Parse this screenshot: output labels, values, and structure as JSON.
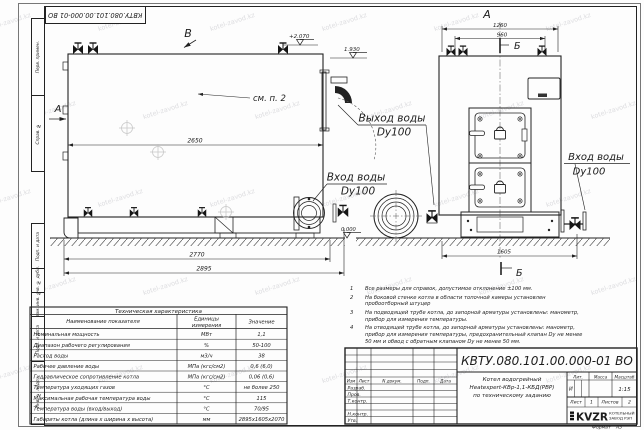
{
  "sheet": {
    "stamp_top": "КВТУ.080.101.00.000-01  ВО",
    "format_label": "Формат",
    "format_value": "А3",
    "margin_labels": [
      "Перв. примен.",
      "Справ. №",
      "Подп. и дата",
      "Инв. № дубл.",
      "Взам. инв. №",
      "Подп. и дата",
      "Инв. № подл."
    ],
    "watermark": "kotel-zavod.kz"
  },
  "drawing": {
    "views": {
      "top_arrow": "В",
      "front_title": "А",
      "side_arrow": "А",
      "section_mark": "Б"
    },
    "dims": {
      "side_length": "2650",
      "side_base": "2770",
      "side_overall": "2895",
      "front_width": "1260",
      "front_inner": "960",
      "front_overall": "1605"
    },
    "levels": {
      "top": "+2.070",
      "outlet": "1.930",
      "ground": "0.000"
    },
    "callouts": {
      "see_note": "см. п. 2",
      "out_line1": "Выход воды",
      "out_line2": "Dy100",
      "in_line1": "Вход воды",
      "in_line2": "Dy100"
    }
  },
  "spec_table": {
    "title": "Техническая характеристика",
    "col_name": "Наименование показателя",
    "col_unit_1": "Единицы",
    "col_unit_2": "измерения",
    "col_value": "Значение",
    "rows": [
      {
        "name": "Номинальная мощность",
        "unit": "МВт",
        "value": "1,1"
      },
      {
        "name": "Диапазон рабочего регулирования",
        "unit": "%",
        "value": "50-100"
      },
      {
        "name": "Расход воды",
        "unit": "м3/ч",
        "value": "38"
      },
      {
        "name": "Рабочее давление воды",
        "unit": "МПа (кгс/см2)",
        "value": "0,6 (6,0)"
      },
      {
        "name": "Гидравлическое сопротивление котла",
        "unit": "МПа (кгс/см2)",
        "value": "0,06 (0,6)"
      },
      {
        "name": "Температура уходящих газов",
        "unit": "°С",
        "value": "не более 250"
      },
      {
        "name": "Максимальная рабочая температура воды",
        "unit": "°С",
        "value": "115"
      },
      {
        "name": "Температура воды (вход/выход)",
        "unit": "°С",
        "value": "70/95"
      },
      {
        "name": "Габариты котла (длина х ширина х высота)",
        "unit": "мм",
        "value": "2895х1605х2070"
      }
    ]
  },
  "notes": {
    "items": [
      {
        "num": "1",
        "text": "Все размеры для справок, допустимое отклонение ±100 мм."
      },
      {
        "num": "2",
        "text": "На боковой стенке котла в области топочной камеры установлен пробоотборный штуцер"
      },
      {
        "num": "3",
        "text": "На подводящей трубе котла, до запорной арматуры установлены: манометр, прибор для измерения температуры."
      },
      {
        "num": "4",
        "text": "На отводящей трубе котла, до запорной арматуры установлены: манометр, прибор для измерения температуры, предохранительный клапан Dу не менее 50 мм и обвод с обратным клапаном Dу не менее 50 мм."
      }
    ]
  },
  "title_block": {
    "doc_number": "КВТУ.080.101.00.000-01 ВО",
    "product_lines": [
      "Котел водогрейный",
      "Heatexpert-КВр-1,1-КБД(РВР)",
      "по техническому заданию"
    ],
    "cols": {
      "izm": "Изм",
      "list": "Лист",
      "ndoc": "N докум.",
      "podp": "Подп.",
      "data": "Дата"
    },
    "rows": {
      "razrab": "Разраб.",
      "prov": "Пров.",
      "tkontr": "Т.контр.",
      "nkontr": "Н.контр.",
      "utv": "Утв."
    },
    "lit_label": "Лит.",
    "mass_label": "Масса",
    "scale_label": "Масштаб",
    "lit_value": "И",
    "scale_value": "1:15",
    "sheet_label": "Лист",
    "sheet_value": "1",
    "sheets_label": "Листов",
    "sheets_value": "2",
    "logo": "KVZR",
    "company_lines": [
      "КОТЕЛЬНЫЙ",
      "ЗАВОД РЭП"
    ]
  }
}
